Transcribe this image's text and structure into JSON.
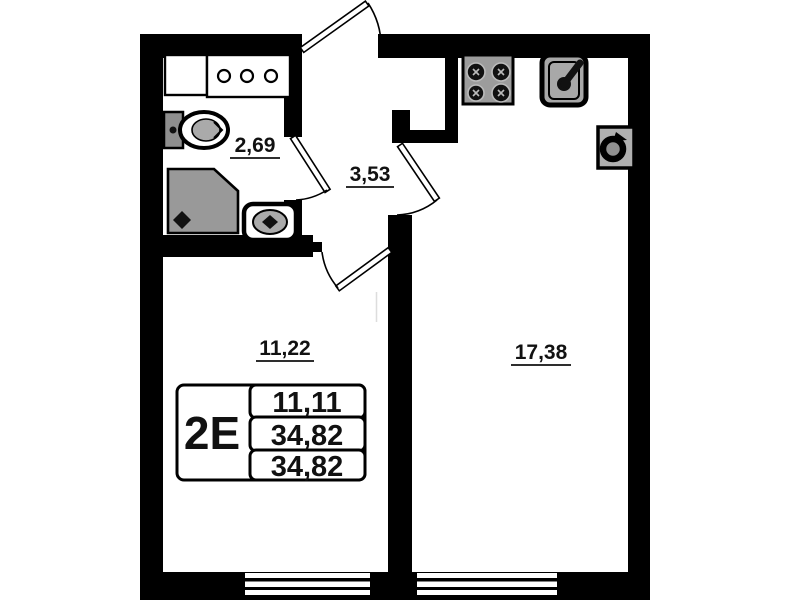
{
  "plan": {
    "apartment_type": "2E",
    "rooms": [
      {
        "name": "bathroom",
        "area": "2,69"
      },
      {
        "name": "hallway",
        "area": "3,53"
      },
      {
        "name": "room",
        "area": "11,22"
      },
      {
        "name": "kitchen-living-room",
        "area": "17,38"
      }
    ],
    "info_table": {
      "type": "2E",
      "values": [
        "11,11",
        "34,82",
        "34,82"
      ]
    },
    "icons": [
      "washing-machine-icon",
      "vanity-cabinet-icon",
      "toilet-icon",
      "shower-cabin-icon",
      "washbasin-icon",
      "stove-icon",
      "kitchen-sink-icon",
      "washer-icon",
      "door-swing-icon",
      "window-icon"
    ],
    "colors": {
      "wall": "#000000",
      "fixture": "#9c9c9c",
      "background": "#ffffff",
      "text": "#111111"
    }
  }
}
